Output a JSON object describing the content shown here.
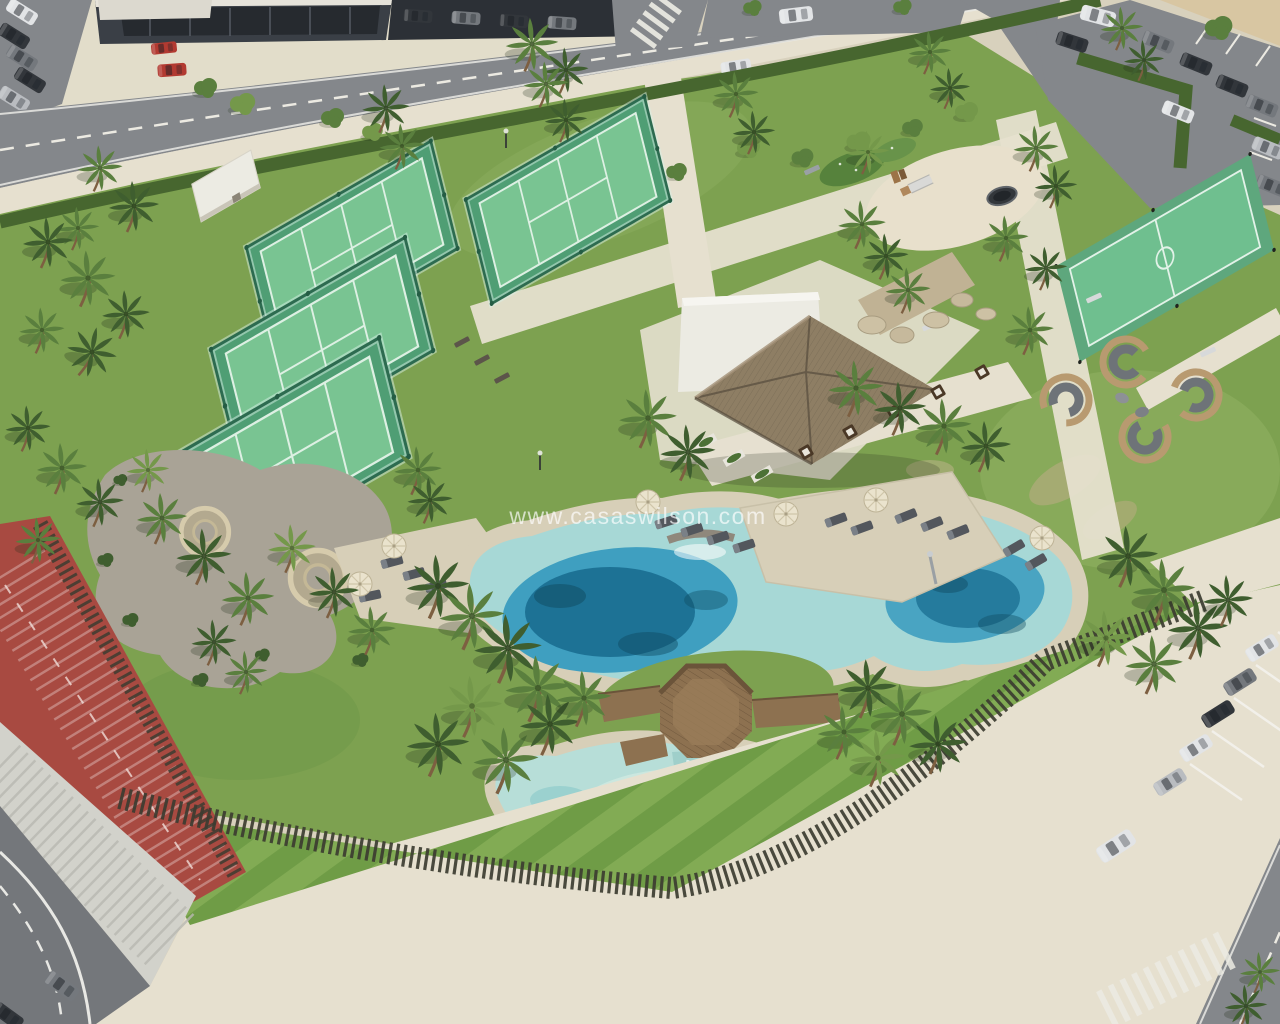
{
  "scene": {
    "watermark": "www.casaswilson.com"
  },
  "palette": {
    "pavement": "#d8d1bd",
    "pavementLight": "#e6e0cf",
    "asphalt": "#84878b",
    "asphaltDark": "#74777b",
    "dirt": "#d8c6a2",
    "lawn": "#7da150",
    "lawnLight": "#93b364",
    "stripeA": "#6f9c46",
    "stripeB": "#82ab54",
    "hedge": "#47662f",
    "palmDark": "#3f5e2f",
    "palmMid": "#5a7f3e",
    "palmLight": "#74984a",
    "trunk": "#7d5f41",
    "courtBase": "#4f9e74",
    "courtSurface": "#79c492",
    "courtLine": "#ddf0e3",
    "courtFence": "#2d6b50",
    "building": "#3a3f46",
    "whiteWall": "#ecebe3",
    "thatch": "#8e7e64",
    "thatchDark": "#6c604e",
    "poolPale": "#a7d8d6",
    "poolMid": "#3f9fc0",
    "poolDeep": "#196d90",
    "poolDark": "#0f4a60",
    "poolShallow": "#b7ded8",
    "sand": "#d7cfb8",
    "wood": "#8d7150",
    "woodDark": "#6b543a",
    "fence": "#3c3c31",
    "track": "#a84a41",
    "steps": "#d2d2cb",
    "stone": "#c0b294",
    "gravel": "#a9a396",
    "carWhite": "#e2e4e6",
    "carSilver": "#b9bcc0",
    "carGray": "#74787d",
    "carDark": "#32363b",
    "carRed": "#b23a31",
    "umbrella": "#eae3cd",
    "cushion": "#53575d",
    "podwood": "#b89a70"
  }
}
